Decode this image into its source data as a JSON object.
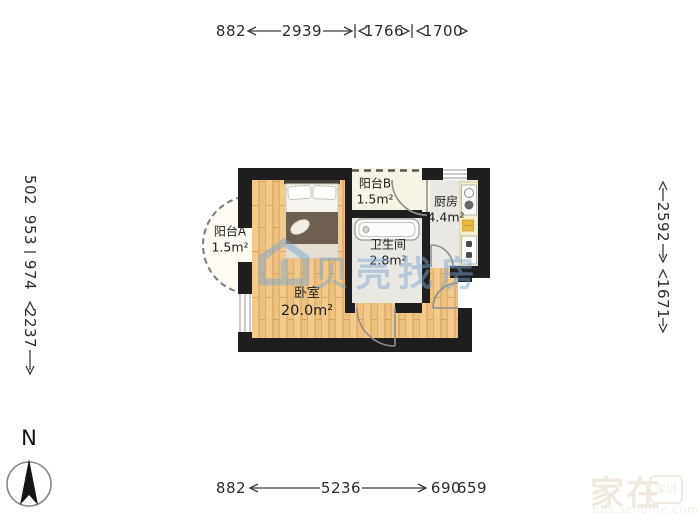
{
  "plan": {
    "rooms": [
      {
        "id": "balcony-b",
        "name": "阳台B",
        "area": "1.5m²"
      },
      {
        "id": "kitchen",
        "name": "厨房",
        "area": "4.4m²"
      },
      {
        "id": "bathroom",
        "name": "卫生间",
        "area": "2.8m²"
      },
      {
        "id": "bedroom",
        "name": "卧室",
        "area": "20.0m²"
      },
      {
        "id": "balcony-a",
        "name": "阳台A",
        "area": "1.5m²"
      }
    ]
  },
  "dimensions": {
    "top": [
      "882",
      "2939",
      "1766",
      "1700"
    ],
    "bottom": [
      "882",
      "5236",
      "690",
      "659"
    ],
    "left": [
      "502",
      "953",
      "974",
      "2237"
    ],
    "right": [
      "2592",
      "1671"
    ]
  },
  "compass": {
    "north_label": "N"
  },
  "watermarks": {
    "center_text": "贝壳找房",
    "corner_text": "家在",
    "corner_seal": "深圳",
    "corner_url": "bbs.szhome.com"
  },
  "colors": {
    "wall": "#1f1f1f",
    "wood_floor": "#eec17e",
    "tile_floor": "#eae8e3",
    "balcony_floor": "#f8f4e5",
    "counter": "#f6efcd",
    "watermark_blue": "#7aa6d2",
    "dimension_text": "#2b2b2b"
  }
}
